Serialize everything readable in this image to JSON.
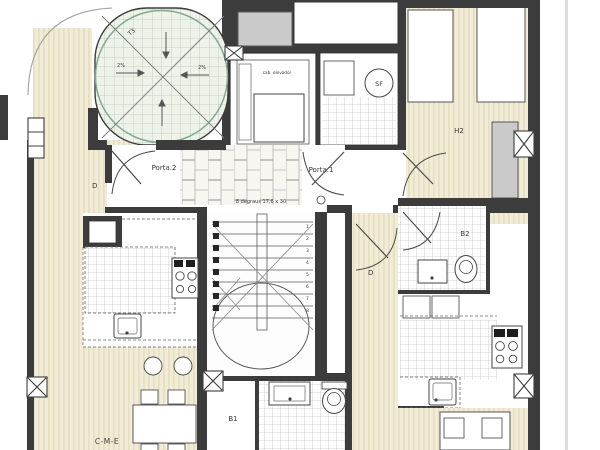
{
  "colors": {
    "wall": "#3c3c3c",
    "wood_floor": "#f2ecd7",
    "wood_stripe": "#e4dcbe",
    "tile_bg": "#ffffff",
    "tile_line": "#c6c6c6",
    "brick_bg": "#f7f6f1",
    "terrace_bg": "#eef3ea",
    "terrace_grid": "#b9c7b6",
    "terrace_ring": "#85a894",
    "gray_fill": "#cacaca"
  },
  "labels": {
    "porta_1": "Porta.1",
    "porta_2": "Porta.2",
    "room_h2": "H2",
    "bath_b1": "B1",
    "bath_b2": "B2",
    "hall_left": "D",
    "hall_right": "D",
    "dining_left": "C-M-E",
    "appliance_sf": "SF",
    "terrace_mark": "T3",
    "slope_left": "2%",
    "slope_right": "2%",
    "stair_note": "8 degraus 17,6 x 30",
    "elevator_note": "cab. elevador"
  },
  "stairs": {
    "steps": [
      "1",
      "2",
      "3",
      "4",
      "5",
      "6",
      "7",
      "8"
    ]
  }
}
